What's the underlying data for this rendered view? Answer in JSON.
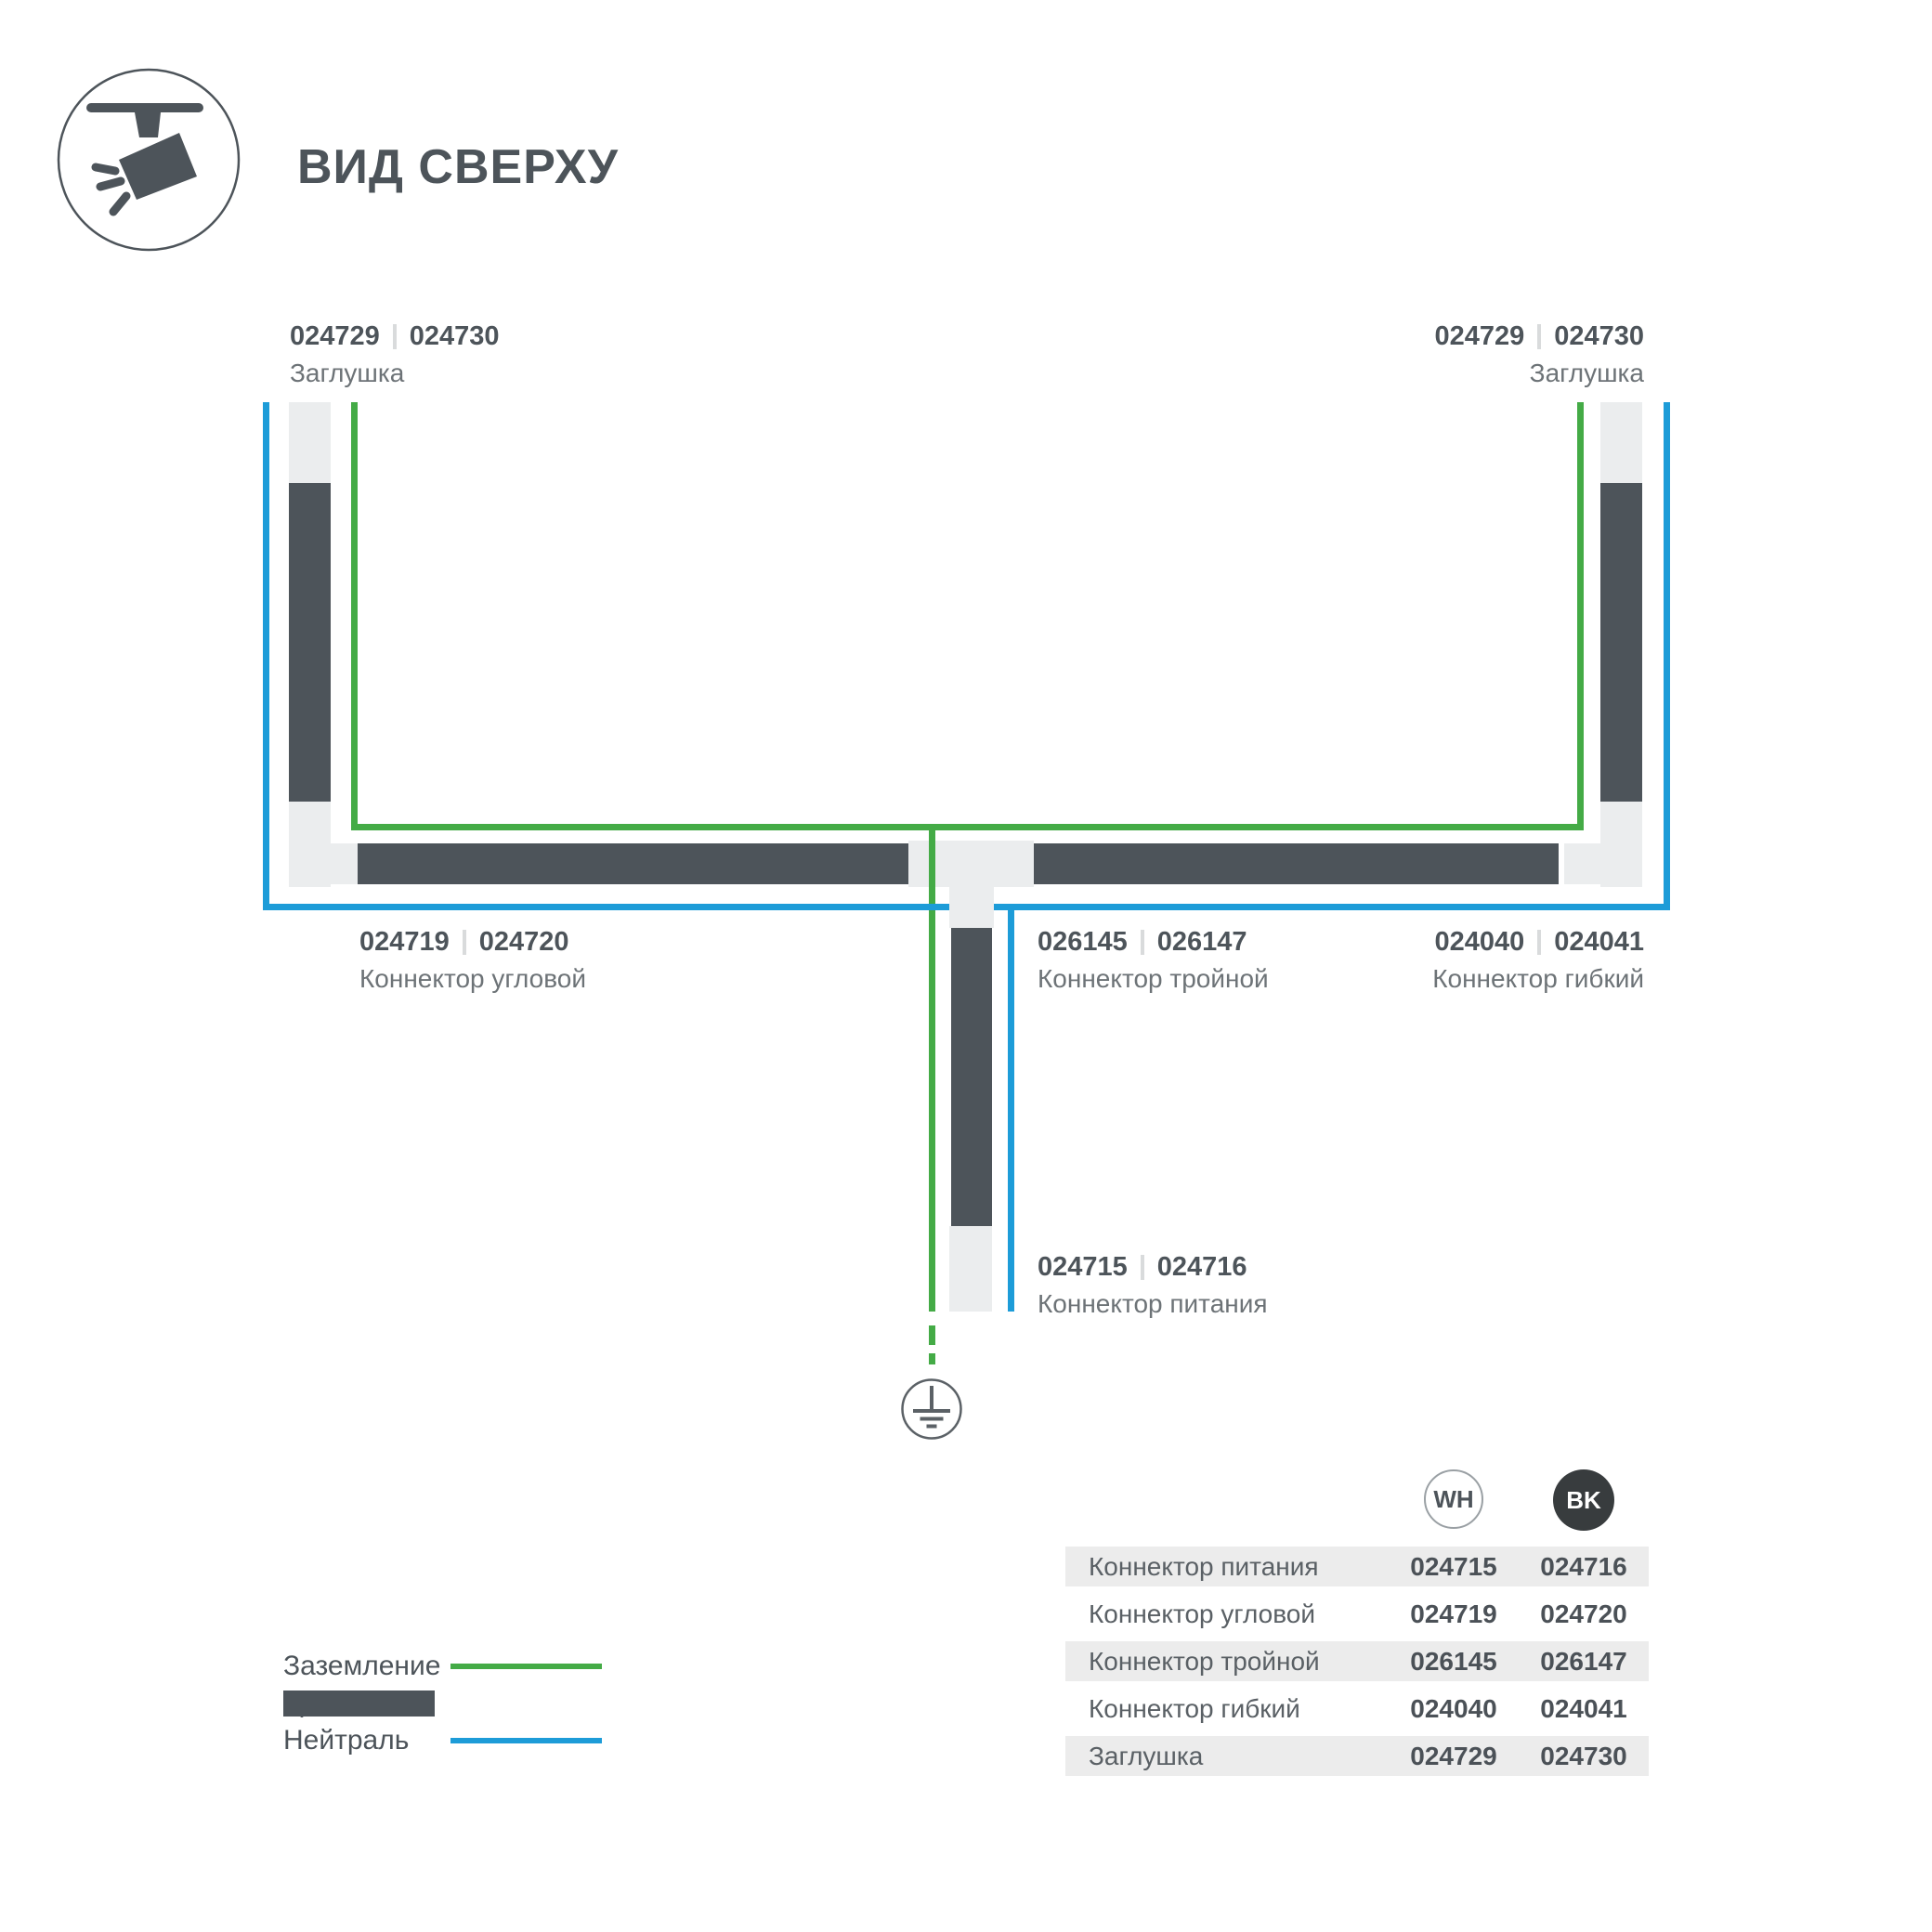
{
  "header": {
    "title": "ВИД СВЕРХУ"
  },
  "colors": {
    "ground_green": "#44ab46",
    "neutral_blue": "#1d9cd8",
    "track_dark": "#4d545a",
    "connector_gray": "#ebedee",
    "table_stripe": "#ececec"
  },
  "diagram": {
    "labels": {
      "cap_left": {
        "wh": "024729",
        "bk": "024730",
        "name": "Заглушка"
      },
      "cap_right": {
        "wh": "024729",
        "bk": "024730",
        "name": "Заглушка"
      },
      "corner": {
        "wh": "024719",
        "bk": "024720",
        "name": "Коннектор угловой"
      },
      "triple": {
        "wh": "026145",
        "bk": "026147",
        "name": "Коннектор тройной"
      },
      "flexible": {
        "wh": "024040",
        "bk": "024041",
        "name": "Коннектор гибкий"
      },
      "power": {
        "wh": "024715",
        "bk": "024716",
        "name": "Коннектор питания"
      }
    }
  },
  "legend": {
    "items": [
      {
        "label": "Заземление",
        "type": "ground"
      },
      {
        "label": "Трек",
        "type": "track"
      },
      {
        "label": "Нейтраль",
        "type": "neutral"
      }
    ]
  },
  "table": {
    "columns": [
      {
        "badge": "WH"
      },
      {
        "badge": "BK"
      }
    ],
    "rows": [
      {
        "name": "Коннектор питания",
        "wh": "024715",
        "bk": "024716"
      },
      {
        "name": "Коннектор угловой",
        "wh": "024719",
        "bk": "024720"
      },
      {
        "name": "Коннектор тройной",
        "wh": "026145",
        "bk": "026147"
      },
      {
        "name": "Коннектор гибкий",
        "wh": "024040",
        "bk": "024041"
      },
      {
        "name": "Заглушка",
        "wh": "024729",
        "bk": "024730"
      }
    ]
  }
}
